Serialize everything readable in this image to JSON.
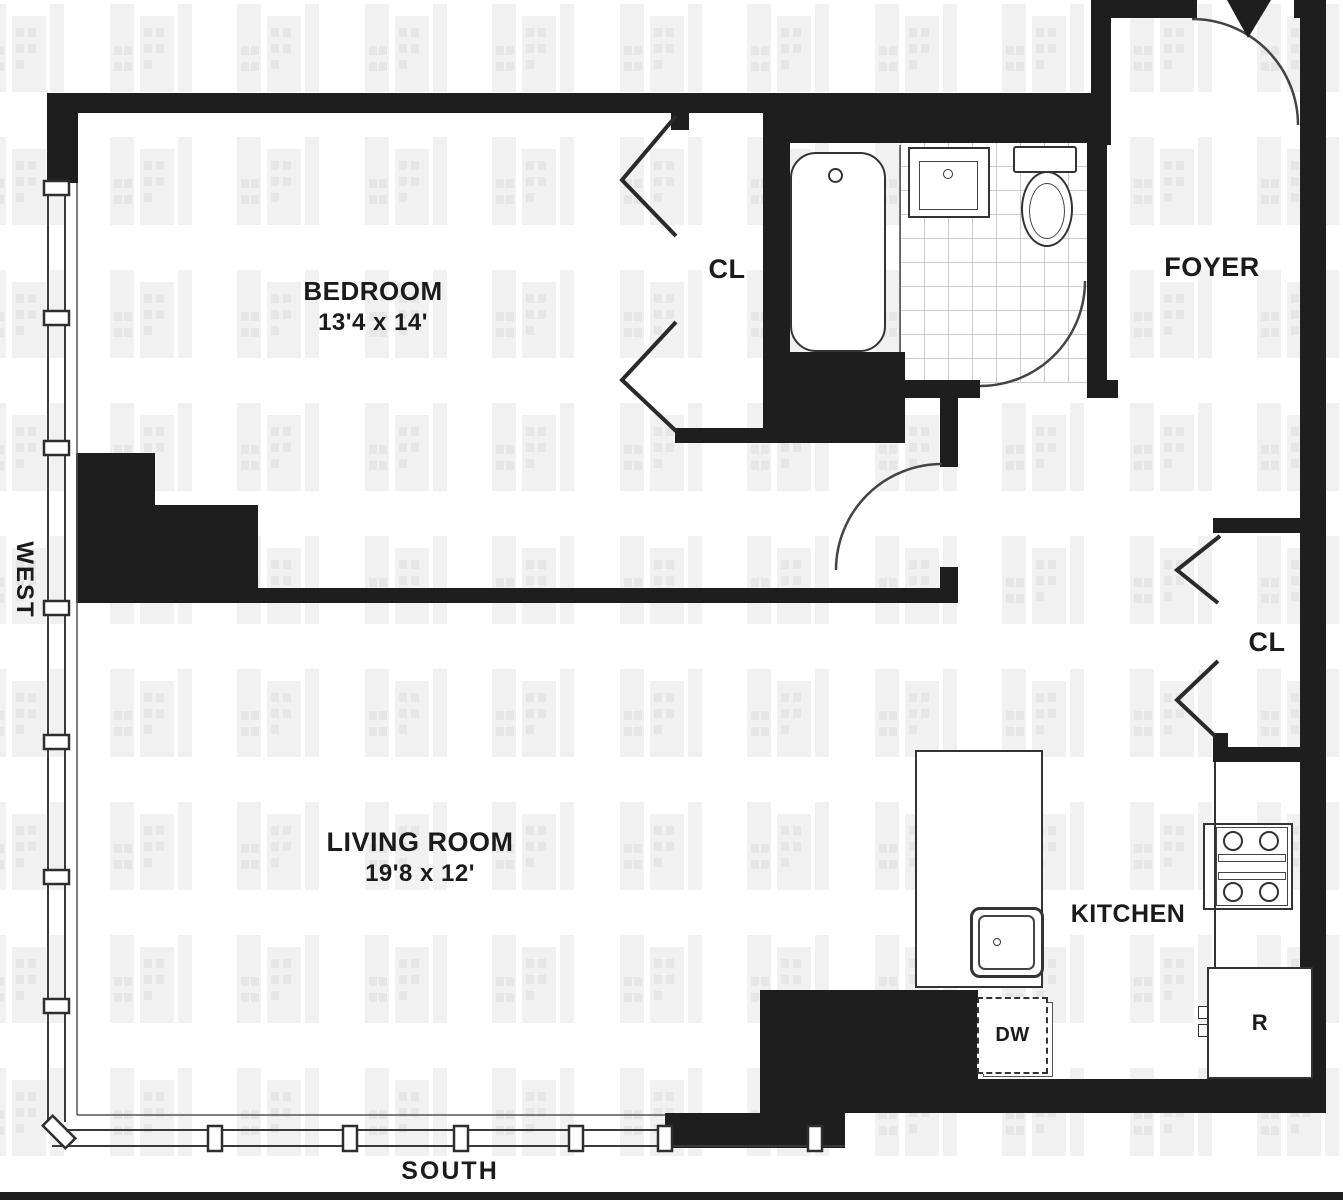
{
  "plan": {
    "rooms": {
      "bedroom": {
        "name": "BEDROOM",
        "dims": "13'4 x 14'"
      },
      "living_room": {
        "name": "LIVING ROOM",
        "dims": "19'8 x 12'"
      },
      "kitchen": {
        "name": "KITCHEN"
      },
      "foyer": {
        "name": "FOYER"
      }
    },
    "closets": {
      "bedroom_closet": "CL",
      "hall_closet": "CL"
    },
    "appliances": {
      "dishwasher": "DW",
      "refrigerator": "R"
    },
    "orientation": {
      "west": "WEST",
      "south": "SOUTH"
    },
    "icons": [
      "bathtub-icon",
      "bathroom-sink-icon",
      "toilet-icon",
      "kitchen-sink-icon",
      "stove-icon",
      "entry-door-swing-icon",
      "door-arc-icon",
      "closet-chevron-icon",
      "window-mullion-icon",
      "building-watermark-icon"
    ]
  },
  "colors": {
    "wall": "#1e1e1e",
    "line": "#3a3a3a",
    "tile_line": "#cccccc",
    "watermark_bar": "#f1f1f1",
    "watermark_window": "#e6e6e6"
  }
}
